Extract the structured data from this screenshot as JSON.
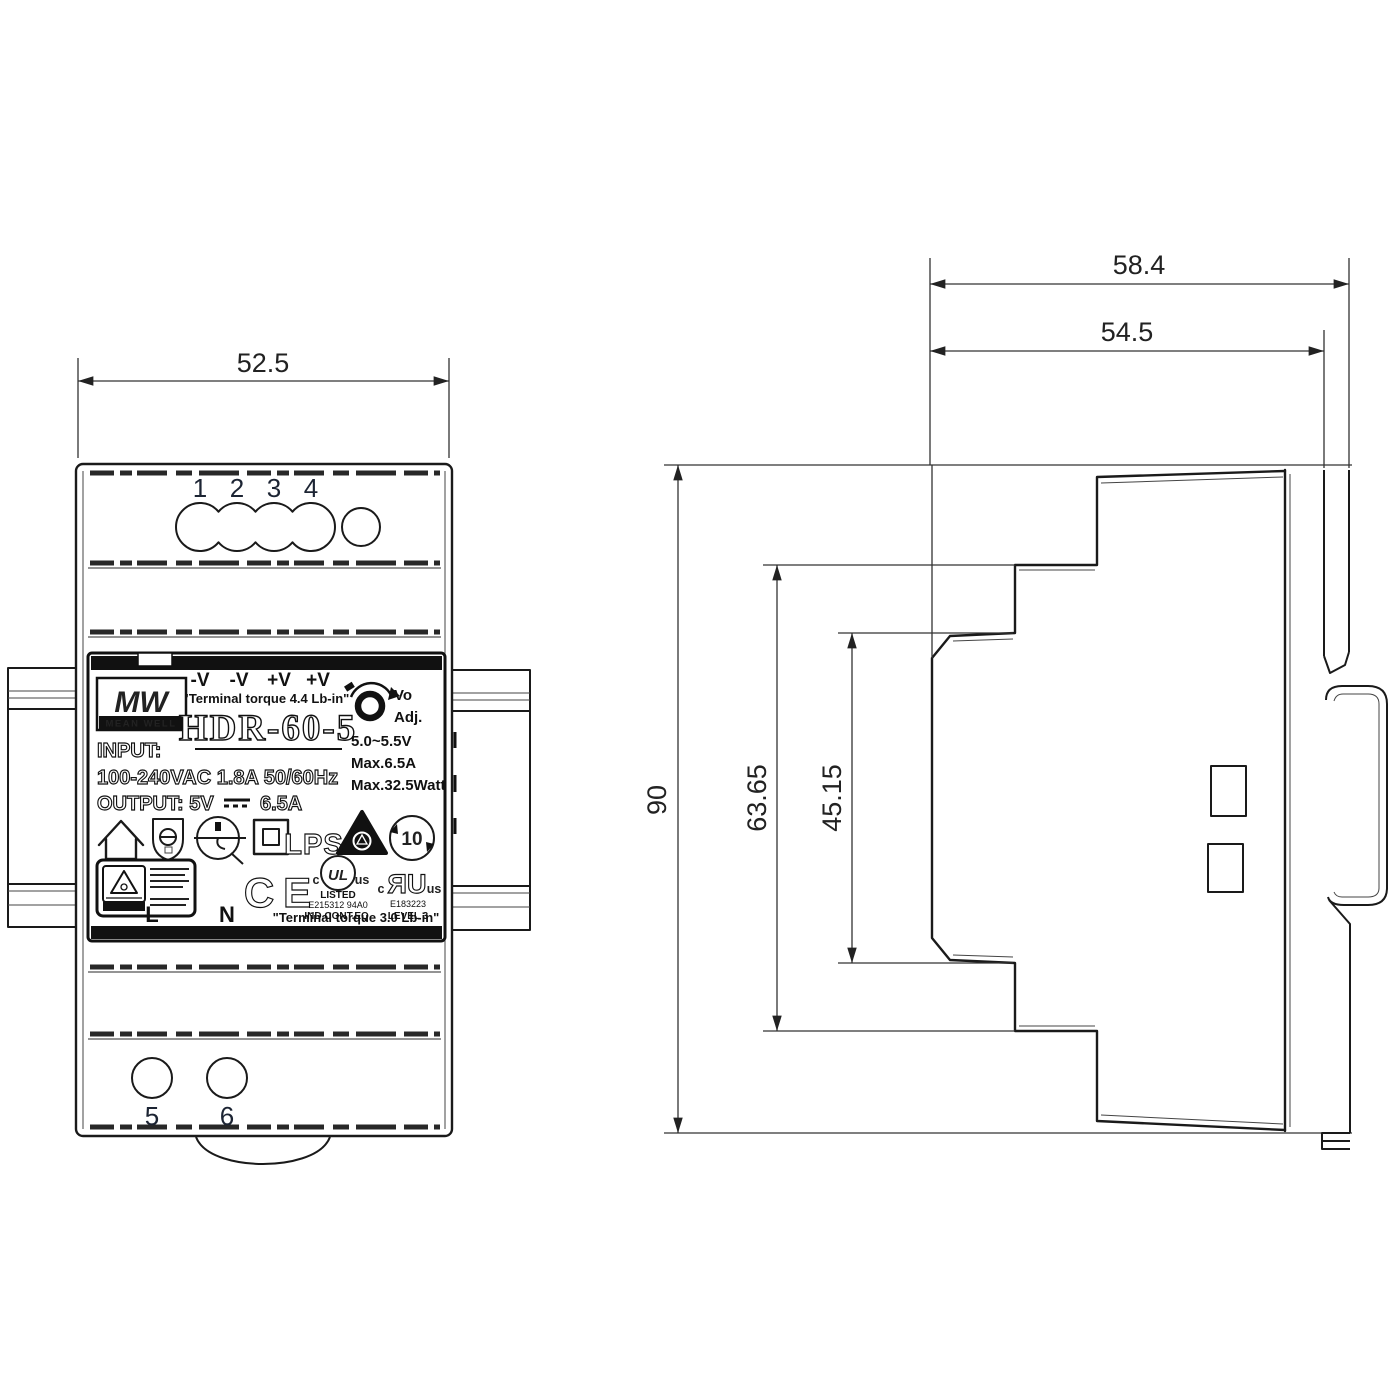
{
  "front": {
    "dim_width": "52.5",
    "terminals_top": [
      "1",
      "2",
      "3",
      "4"
    ],
    "terminals_bottom": [
      "5",
      "6"
    ],
    "label": {
      "polarity": [
        "-V",
        "-V",
        "+V",
        "+V"
      ],
      "torque_top": "\"Terminal torque 4.4 Lb-in\"",
      "brand_logo": "MW",
      "brand_name": "MEAN WELL",
      "model": "HDR-60-5",
      "adj_line1": "Vo",
      "adj_line2": "Adj.",
      "spec_voltage": "5.0~5.5V",
      "spec_current": "Max.6.5A",
      "spec_power": "Max.32.5Watt",
      "input_label": "INPUT:",
      "input_rating": "100-240VAC 1.8A 50/60Hz",
      "output_label": "OUTPUT: 5V",
      "output_current": "6.5A",
      "lps": "LPS",
      "efup": "10",
      "ce": "CE",
      "ul_listed": {
        "c": "c",
        "ul": "UL",
        "us": "us",
        "l1": "LISTED",
        "l2": "E215312  94A0",
        "l3": "IND.CONT.EQ."
      },
      "ul_recognized": {
        "c": "c",
        "ru": "ЯU",
        "us": "us",
        "l1": "E183223",
        "l2": "LEVEL 3"
      },
      "line": "L",
      "neutral": "N",
      "torque_bottom": "\"Terminal torque 3.0 Lb-in\""
    }
  },
  "side": {
    "dim_total_width": "58.4",
    "dim_body_width": "54.5",
    "dim_height": "90",
    "dim_step1": "63.65",
    "dim_step2": "45.15"
  },
  "colors": {
    "line": "#1a1a1a",
    "text": "#222222",
    "bar": "#111111"
  }
}
